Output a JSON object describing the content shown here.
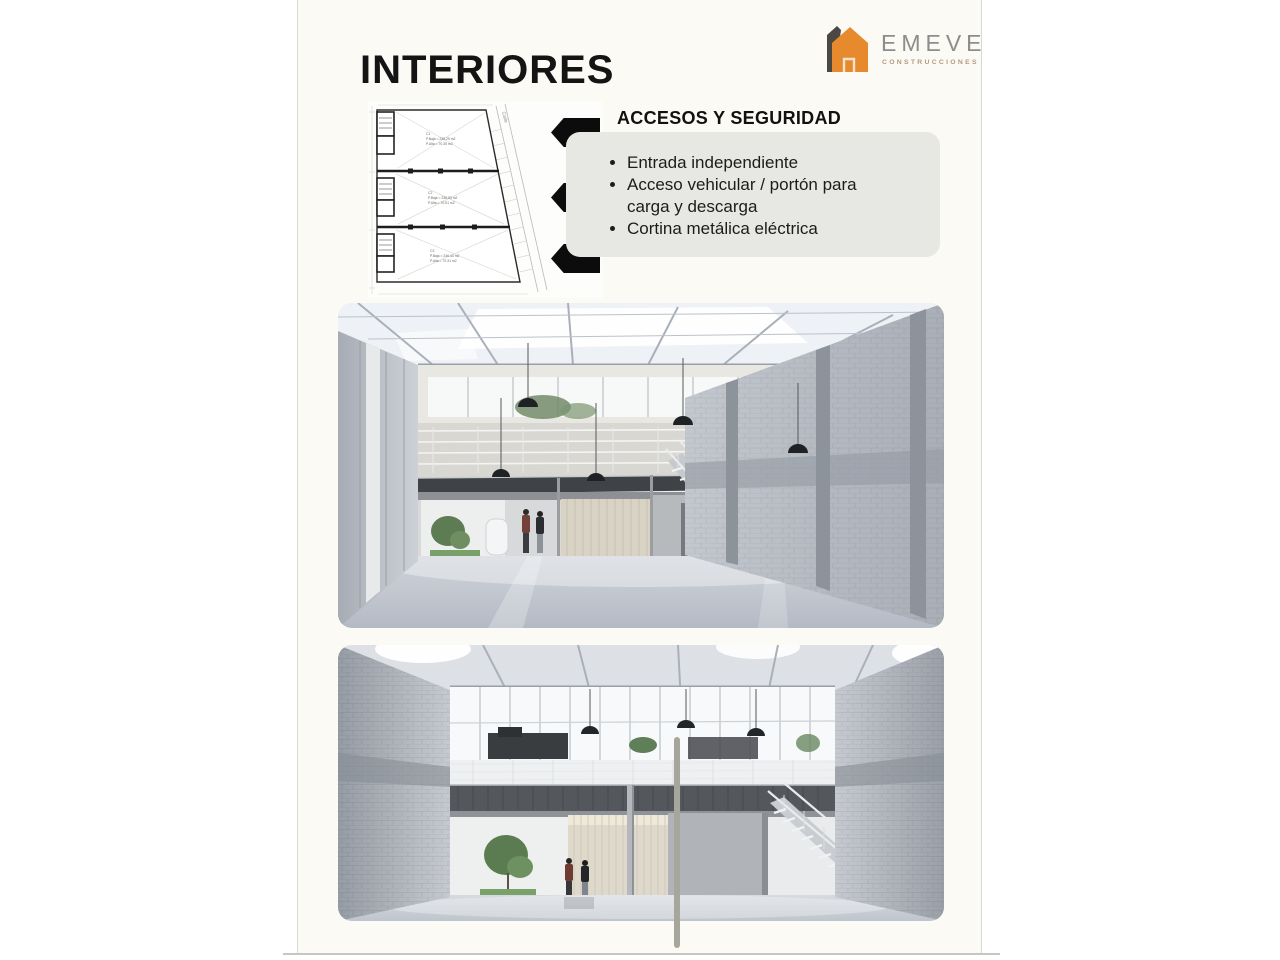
{
  "slide": {
    "title": "INTERIORES",
    "logo": {
      "brand": "EMEVE",
      "tagline": "CONSTRUCCIONES",
      "accent_color": "#e78a2e"
    },
    "section": {
      "heading": "ACCESOS Y SEGURIDAD",
      "bullets": [
        "Entrada independiente",
        "Acceso vehicular / portón para carga y descarga",
        "Cortina metálica eléctrica"
      ]
    },
    "floorplan": {
      "street_label": "Calle",
      "units": [
        {
          "id": "C1",
          "area1": "P.Baja = 238.29 m2",
          "area2": "P.Alta = 70.35 m2"
        },
        {
          "id": "C2",
          "area1": "P.Baja = 236.53 m2",
          "area2": "P.Alta = 70.51 m2"
        },
        {
          "id": "C3",
          "area1": "P.Baja = 246.44 m2",
          "area2": "P.Alta = 70.31 m2"
        }
      ]
    },
    "colors": {
      "page_bg": "#fbfaf5",
      "box_bg": "#e7e7e4",
      "arrow": "#0c0c0c"
    }
  }
}
